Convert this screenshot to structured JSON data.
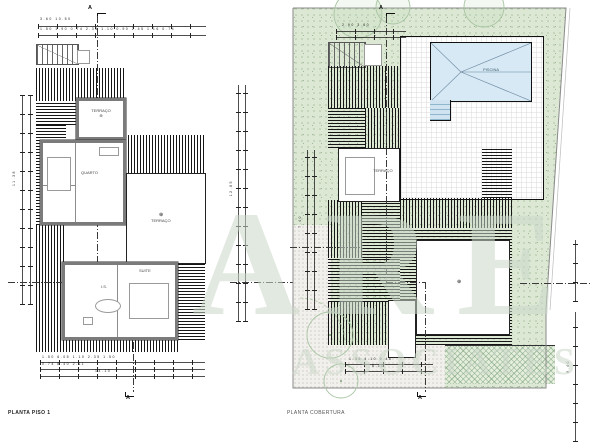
{
  "sheet": {
    "background": "#ffffff"
  },
  "left_plan": {
    "caption": "PLANTA PISO 1",
    "section_marker": "A",
    "rooms": {
      "terrace_top": "TERRAÇO",
      "bedroom": "QUARTO",
      "suite": "SUITE",
      "bath": "I.S.",
      "terrace_right": "TERRAÇO"
    },
    "levels": {
      "cross": "⊕"
    },
    "dims": {
      "top1": "3.60                                   10.50",
      "top2": "1.50   1.90   0.74  2.35  1.10  0.90  2.45  1.16  0.74",
      "left_v": "11.38",
      "right_v": "12.85",
      "bottom1": "1.50      6.05      1.10    2.35     1.50",
      "bottom2": "0.74           8.40            2.11",
      "bottom3": "14.10"
    }
  },
  "right_plan": {
    "caption": "PLANTA COBERTURA",
    "section_marker": "A",
    "pool_label": "PISCINA",
    "rooms": {
      "roof_patio": "TERRAÇO"
    },
    "levels": {
      "cross": "⊕"
    },
    "dims": {
      "top": "2.90   3.60",
      "left_v": "7.40",
      "right_v": "9.40",
      "bottom1": "1.35    4.10    0.45",
      "bottom2": "6.10"
    }
  },
  "watermark": {
    "primary": "ARE",
    "secondary": "ASSOCIATES"
  },
  "colors": {
    "lawn": "#dce8d4",
    "pool": "#d6e9f4",
    "hatch": "#161616",
    "wall": "#7b7b7b",
    "boundary": "#8a8a8a",
    "watermark": "rgba(202,215,200,0.55)"
  }
}
